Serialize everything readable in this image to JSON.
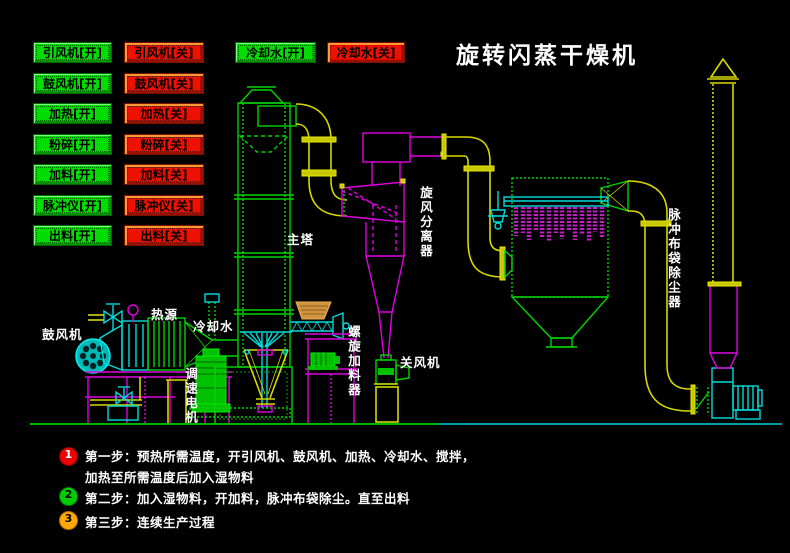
{
  "title": "旋转闪蒸干燥机",
  "buttons": {
    "on": [
      "引风机[开]",
      "鼓风机[开]",
      "加热[开]",
      "粉碎[开]",
      "加料[开]",
      "脉冲仪[开]",
      "出料[开]"
    ],
    "off": [
      "引风机[关]",
      "鼓风机[关]",
      "加热[关]",
      "粉碎[关]",
      "加料[关]",
      "脉冲仪[关]",
      "出料[关]"
    ],
    "cooling_on": "冷却水[开]",
    "cooling_off": "冷却水[关]"
  },
  "labels": {
    "main_tower": "主塔",
    "cyclone": "旋风分离器",
    "bag_filter": "脉冲布袋除尘器",
    "rotary_valve": "关风机",
    "screw_feeder": "螺旋加料器",
    "speed_motor": "调速电机",
    "blower": "鼓风机",
    "heat_source": "热源",
    "cooling_water": "冷却水"
  },
  "steps": [
    {
      "num": "1",
      "lines": [
        "第一步：预热所需温度，开引风机、鼓风机、加热、冷却水、搅拌，",
        "加热至所需温度后加入湿物料"
      ]
    },
    {
      "num": "2",
      "lines": [
        "第二步：加入湿物料，开加料，脉冲布袋除尘。直至出料"
      ]
    },
    {
      "num": "3",
      "lines": [
        "第三步：连续生产过程"
      ]
    }
  ],
  "colors": {
    "green": "#00dd00",
    "red": "#ee1100",
    "yellow": "#d8d800",
    "magenta": "#e000e0",
    "cyan": "#00dcdc",
    "white": "#ffffff"
  }
}
